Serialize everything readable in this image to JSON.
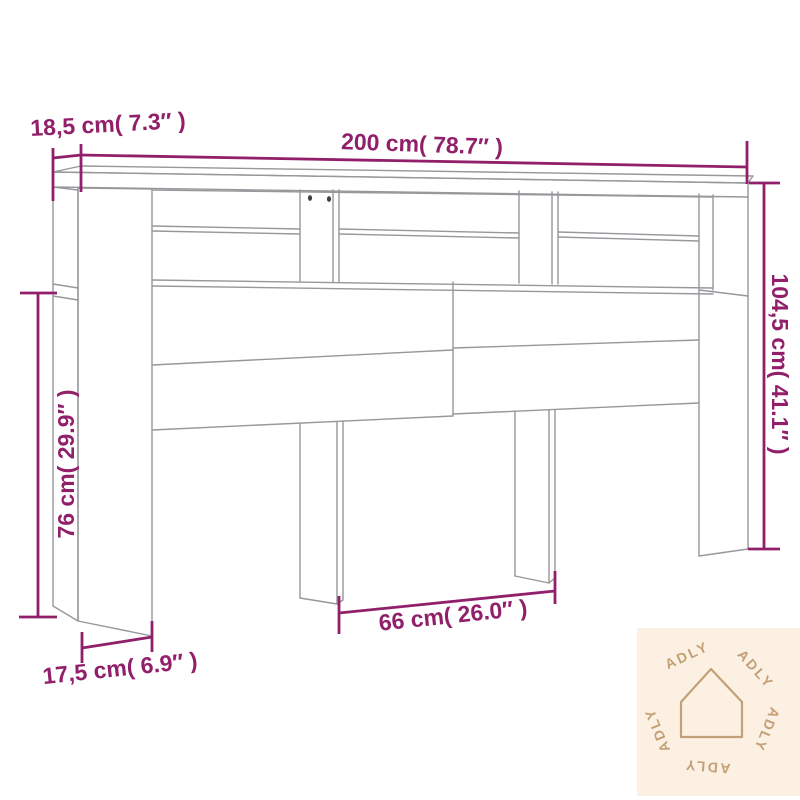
{
  "dimensions": {
    "top_depth": "18,5 cm( 7.3″ )",
    "total_width": "200 cm( 78.7″ )",
    "total_height": "104,5 cm( 41.1″ )",
    "side_height": "76 cm( 29.9″ )",
    "center_opening_width": "66 cm( 26.0″ )",
    "leg_depth": "17,5 cm( 6.9″ )"
  },
  "watermark": {
    "brand": "ADLY"
  },
  "colors": {
    "line": "#97979c",
    "dimension": "#911f6a",
    "hole": "#404040",
    "watermark_bg": "#fbf0e2",
    "watermark_fg": "#c3a077"
  }
}
